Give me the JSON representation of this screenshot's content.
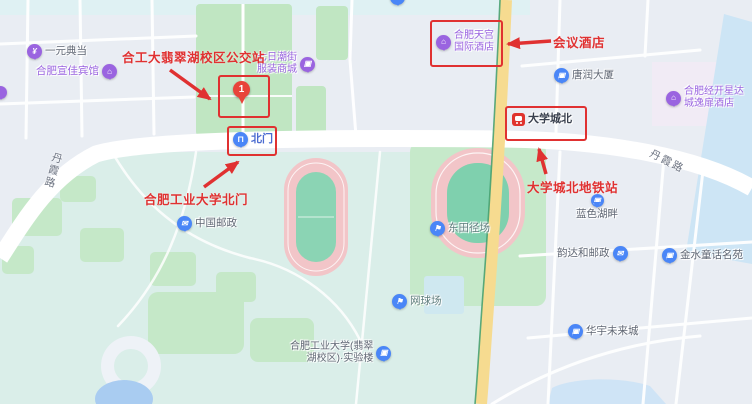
{
  "annotations": {
    "bus_stop_label": "合工大翡翠湖校区公交站",
    "north_gate_label": "合肥工业大学北门",
    "conference_hotel_label": "会议酒店",
    "metro_station_label": "大学城北地铁站",
    "marker_number": "1"
  },
  "pois": {
    "pawnshop": "一元典当",
    "xuanjia_hotel": "合肥宣佳宾馆",
    "fashion_mall": {
      "line1": "七日潮街",
      "line2": "服装商城"
    },
    "tiangong_hotel": {
      "line1": "合肥天宫",
      "line2": "国际酒店"
    },
    "tangrun_tower": "唐润大厦",
    "xingdacheng_hotel": {
      "line1": "合肥经开星达",
      "line2": "城逸扉酒店"
    },
    "metro_station": "大学城北",
    "north_gate": "北门",
    "china_post": "中国邮政",
    "east_track_field": "东田径场",
    "tennis_court": "网球场",
    "hfut_lab": {
      "line1": "合肥工业大学(翡翠",
      "line2": "湖校区)·实验楼"
    },
    "blue_lakeside": "蓝色湖畔",
    "yunda_post": "韵达和邮政",
    "jinshui_garden": "金水童话名苑",
    "huayu_future_city": "华宇未来城"
  },
  "roads": {
    "danxia_left": "丹霞路",
    "danxia_right": "丹霞路"
  },
  "icons": {
    "pawn_yen": "¥",
    "hotel_house": "⌂",
    "building": "▣",
    "mail": "✉",
    "sport_flag": "⚑",
    "gate": "∏"
  },
  "colors": {
    "annotation_red": "#e03131",
    "poi_purple": "#9a64e0",
    "poi_blue": "#4a86f7",
    "metro_red": "#e0342e",
    "road_yellow": "#f6db90",
    "campus_teal": "#daeee9",
    "park_green": "#c0e6c2"
  }
}
